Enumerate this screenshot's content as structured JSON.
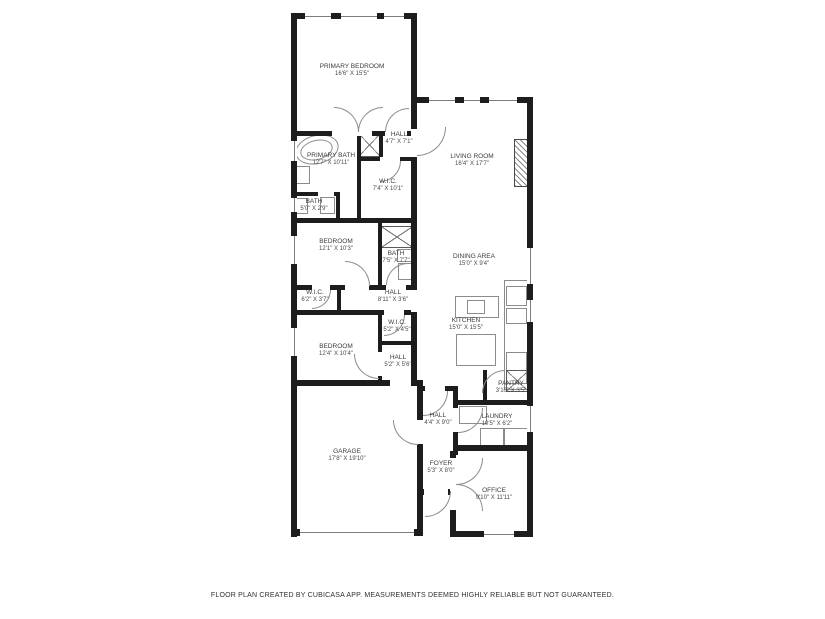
{
  "footer": {
    "disclaimer": "FLOOR PLAN CREATED BY CUBICASA APP. MEASUREMENTS DEEMED HIGHLY RELIABLE BUT NOT GUARANTEED."
  },
  "colors": {
    "wall": "#1d1d1d",
    "label": "#3b3b3b",
    "fixture_line": "#8c8c8c",
    "background": "#ffffff"
  },
  "rooms": [
    {
      "name": "PRIMARY BEDROOM",
      "dims": "16'6\" X 15'5\""
    },
    {
      "name": "HALL",
      "dims": "4'7\" X 7'1\""
    },
    {
      "name": "LIVING ROOM",
      "dims": "16'4\" X 17'7\""
    },
    {
      "name": "PRIMARY BATH",
      "dims": "12'7\" X 10'11\""
    },
    {
      "name": "W.I.C.",
      "dims": "7'4\" X 10'1\""
    },
    {
      "name": "BATH",
      "dims": "5'0\" X 2'9\""
    },
    {
      "name": "BEDROOM",
      "dims": "12'1\" X 10'3\""
    },
    {
      "name": "BATH",
      "dims": "7'5\" X 7'7\""
    },
    {
      "name": "DINING AREA",
      "dims": "15'0\" X 9'4\""
    },
    {
      "name": "W.I.C.",
      "dims": "6'2\" X 3'7\""
    },
    {
      "name": "HALL",
      "dims": "8'11\" X 3'6\""
    },
    {
      "name": "W.I.C.",
      "dims": "5'2\" X 4'5\""
    },
    {
      "name": "BEDROOM",
      "dims": "12'4\" X 10'4\""
    },
    {
      "name": "HALL",
      "dims": "5'2\" X 5'6\""
    },
    {
      "name": "KITCHEN",
      "dims": "15'0\" X 15'5\""
    },
    {
      "name": "GARAGE",
      "dims": "17'8\" X 19'10\""
    },
    {
      "name": "PANTRY",
      "dims": "3'10\" X 3'5\""
    },
    {
      "name": "HALL",
      "dims": "4'4\" X 9'0\""
    },
    {
      "name": "LAUNDRY",
      "dims": "10'5\" X 6'2\""
    },
    {
      "name": "FOYER",
      "dims": "5'3\" X 8'0\""
    },
    {
      "name": "OFFICE",
      "dims": "9'10\" X 11'11\""
    }
  ]
}
